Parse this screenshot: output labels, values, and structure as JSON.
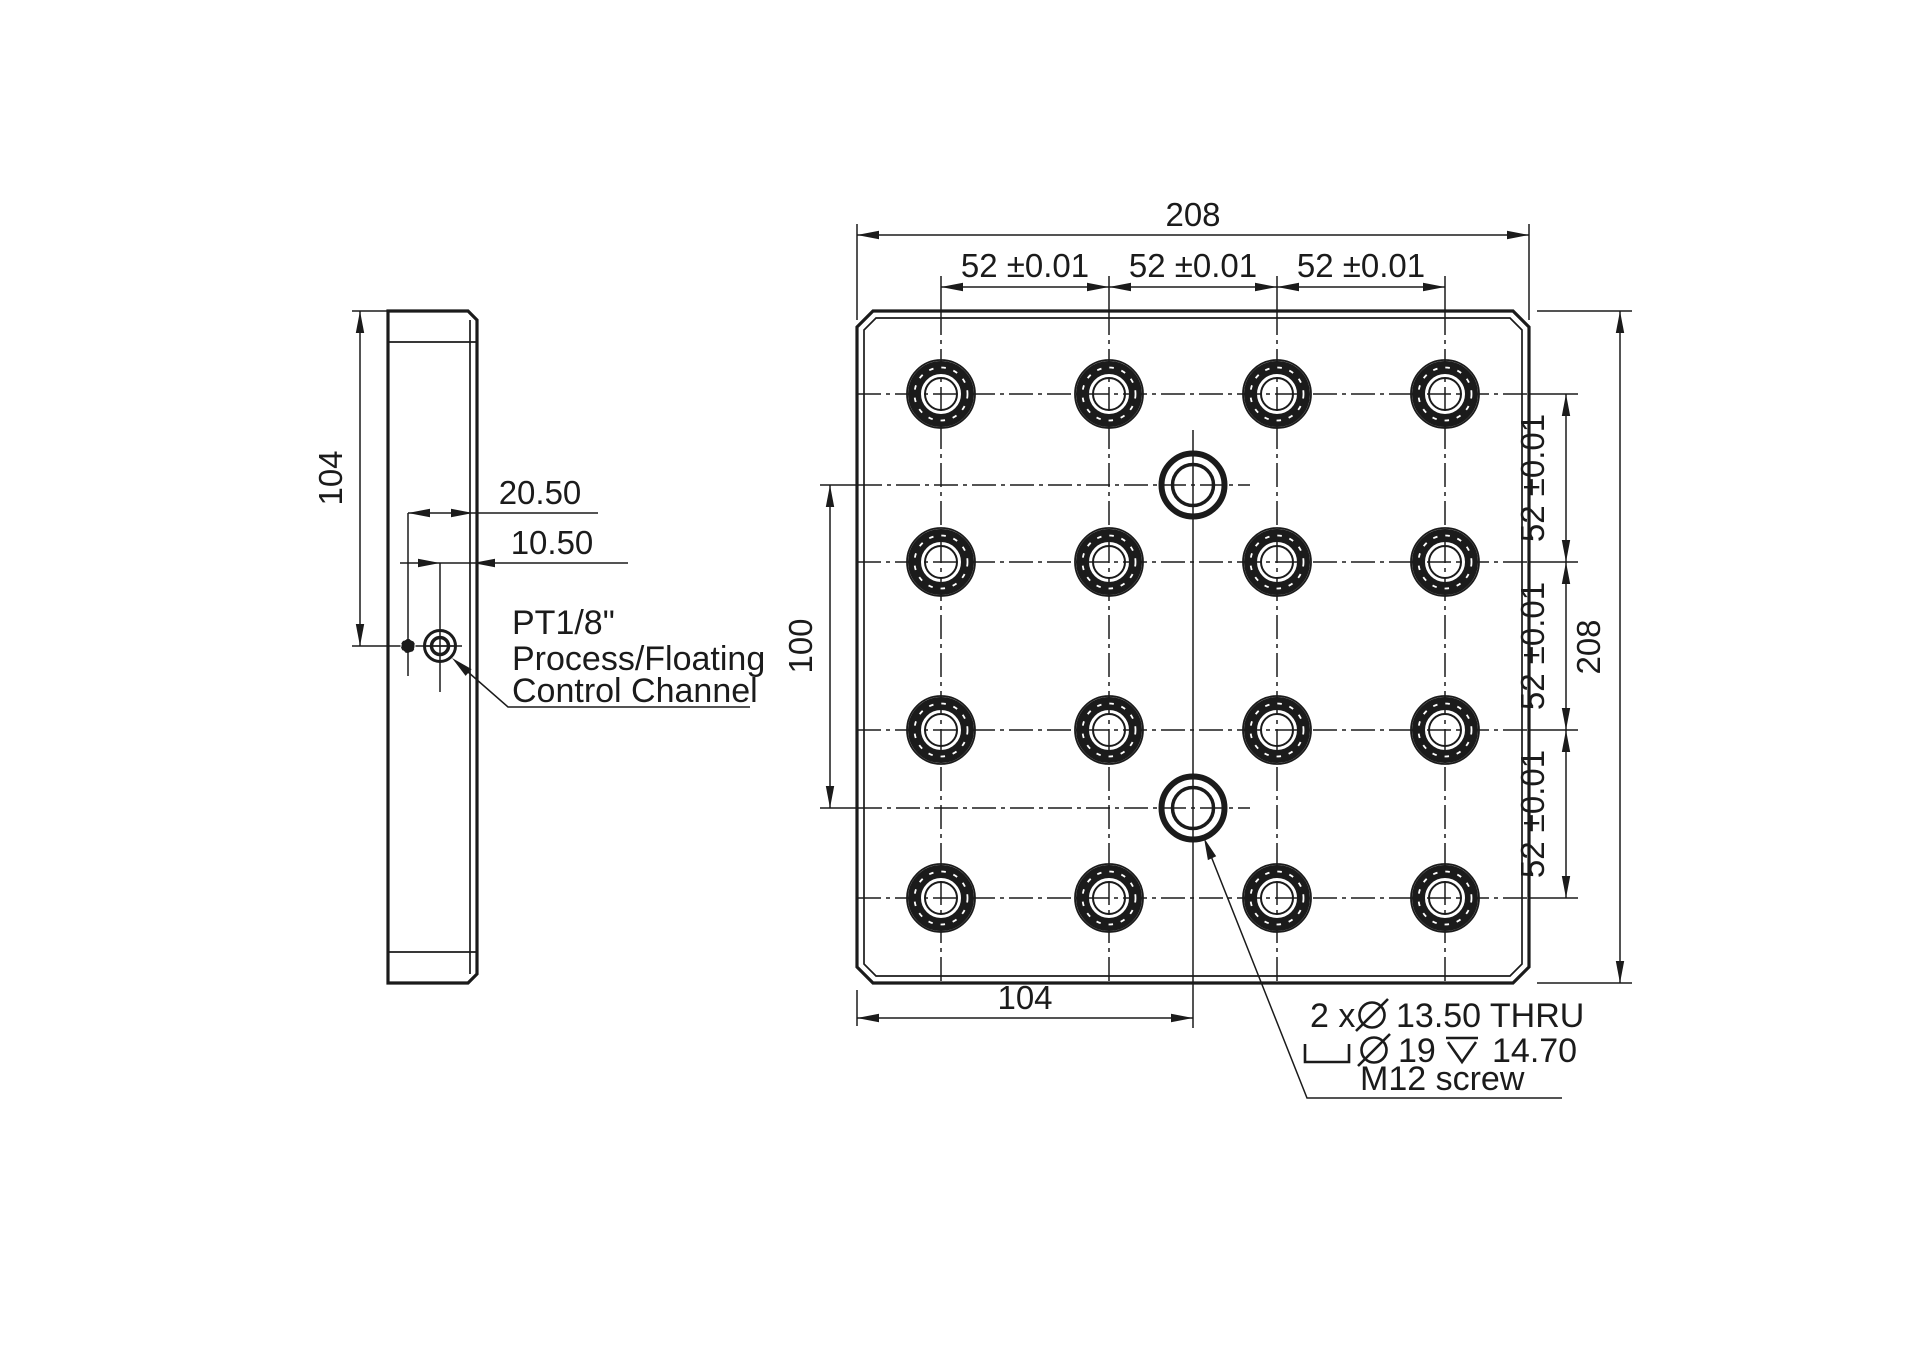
{
  "canvas": {
    "background": "#ffffff",
    "ink": "#1b1b1b"
  },
  "front_view": {
    "dims": {
      "overall_width": "208",
      "overall_height": "208",
      "col_pitch": [
        "52 ±0.01",
        "52 ±0.01",
        "52 ±0.01"
      ],
      "row_pitch": [
        "52 ±0.01",
        "52 ±0.01",
        "52 ±0.01"
      ],
      "port_spacing": "100",
      "port_center_offset": "104"
    },
    "grid": {
      "rows": 4,
      "cols": 4
    },
    "mount_hole_note": {
      "full_lines": [
        "2 x ⌀ 13.50 THRU",
        "⌴ ⌀ 19 ⌵ 14.70",
        "M12 screw"
      ],
      "count_prefix": "2 x",
      "thru_spec": "13.50 THRU",
      "cbore_dia": "19",
      "cbore_depth": "14.70",
      "screw_label": "M12 screw"
    }
  },
  "side_view": {
    "dims": {
      "port_height": "104",
      "port_far_offset": "20.50",
      "port_near_offset": "10.50"
    },
    "port_note": {
      "line1": "PT1/8\"",
      "line2": "Process/Floating",
      "line3": "Control Channel"
    }
  }
}
